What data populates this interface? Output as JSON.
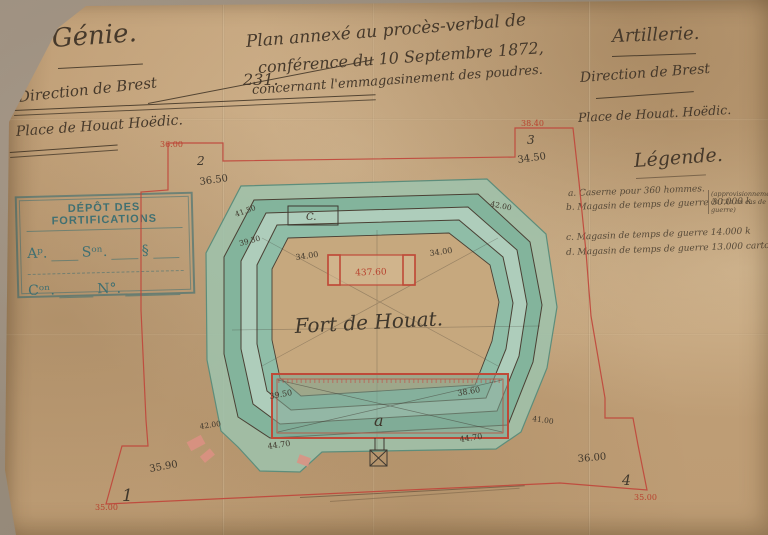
{
  "header": {
    "genie": "Génie.",
    "direction_left": "Direction de Brest",
    "registry_number": "231.",
    "place_left": "Place de Houat Hoëdic.",
    "title_line1": "Plan annexé au procès-verbal de",
    "title_line2": "conférence du 10 Septembre 1872,",
    "title_line3": "concernant l'emmagasinement des poudres.",
    "artillerie": "Artillerie.",
    "direction_right": "Direction de Brest",
    "place_right": "Place de Houat. Hoëdic."
  },
  "stamp": {
    "title": "DÉPÔT DES FORTIFICATIONS",
    "field_art": "Aᵖ.",
    "field_section": "Sᵒⁿ.",
    "field_paragraph": "§",
    "field_carton": "Cᵒⁿ.",
    "field_numero": "N°."
  },
  "legend": {
    "title": "Légende.",
    "items": [
      "a. Caserne pour 360 hommes.",
      "b. Magasin de temps de guerre 30.000 k",
      "c. Magasin de temps de guerre 14.000 k",
      "d. Magasin de temps de guerre 13.000 cartouches."
    ],
    "note": "(approvisionnement de l'île en cas de guerre)"
  },
  "plan": {
    "fort_name": "Fort de Houat.",
    "building_a_label": "a",
    "building_c_label": "C.",
    "magazine_value": "437.60",
    "corner_markers": {
      "c1": "1",
      "c2": "2",
      "c3": "3",
      "c4": "4"
    },
    "red_elevations": {
      "tl": "36.00",
      "tr": "38.40",
      "bl": "35.00",
      "br": "35.00"
    },
    "black_elevations": {
      "tl": "36.50",
      "tr": "34.50",
      "bl": "35.90",
      "br": "36.00"
    },
    "rampart_elevations": {
      "upper_left": "41.50",
      "left": "39.30",
      "upper_right": "42.00",
      "lower_left": "42.00",
      "lower_right": "41.00",
      "court_left": "34.00",
      "court_right": "34.00"
    },
    "caserne_elevations": {
      "tl": "39.50",
      "tr": "38.60",
      "bl": "44.70",
      "br": "44.70"
    }
  },
  "colors": {
    "paper": "#c2a179",
    "mount": "#9b8e7e",
    "ink": "#46392b",
    "red_ink": "#b8432f",
    "stamp_blue": "#2f6a72",
    "rampart_green": "#8cbda7"
  }
}
